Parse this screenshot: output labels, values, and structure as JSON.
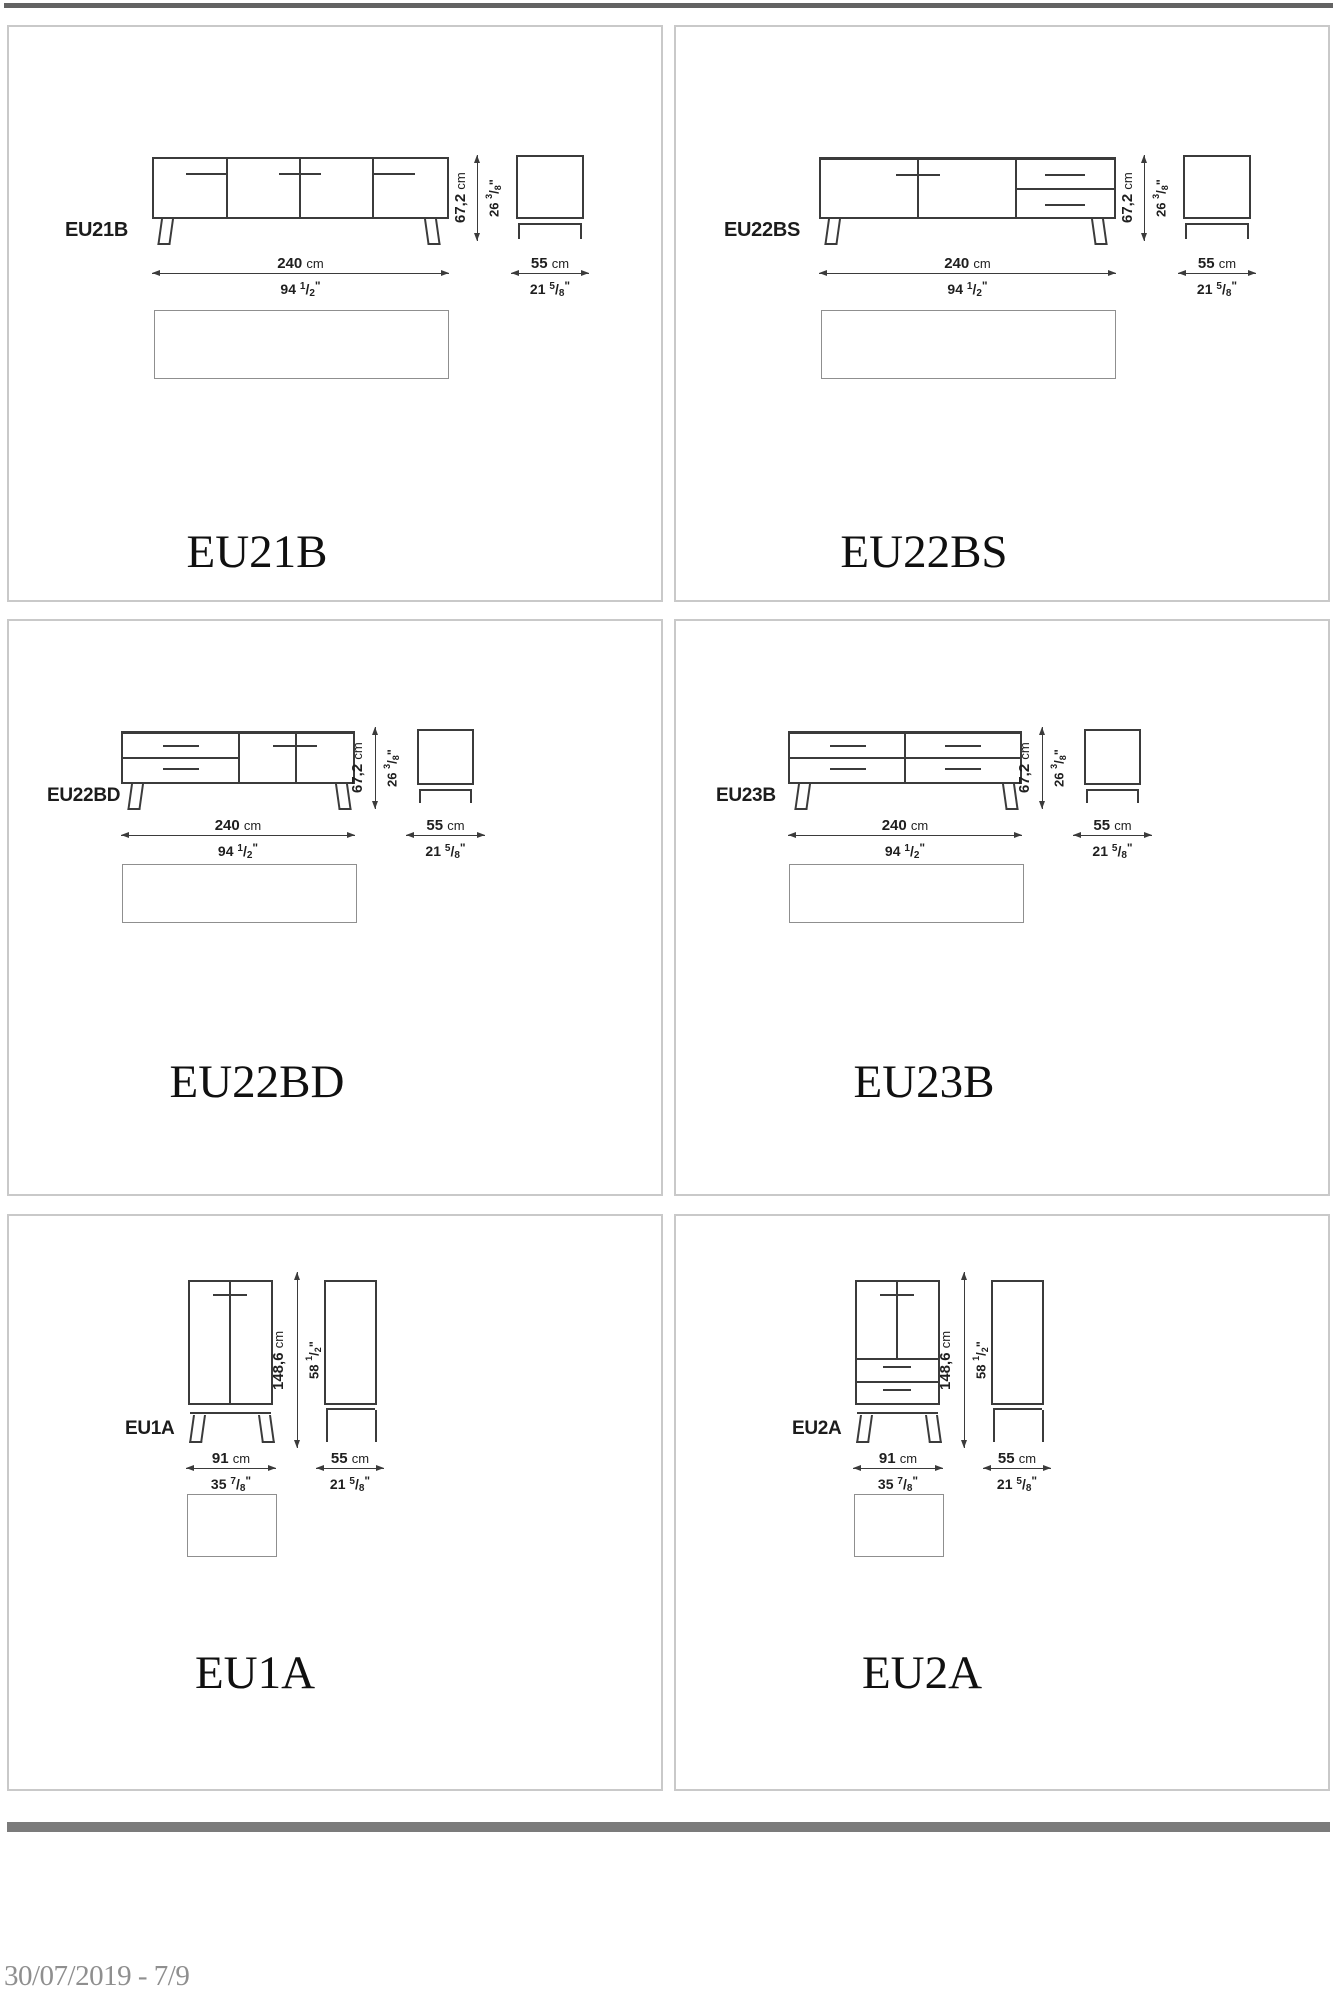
{
  "page": {
    "footer_text": "30/07/2019 - 7/9",
    "top_bar_color": "#636363",
    "footer_bar_color": "#7b7b7b",
    "cell_border_color": "#c9c9c9",
    "drawing_line_color": "#3b3b3b"
  },
  "units": {
    "inch_mark": "\"",
    "frac_slash": "/"
  },
  "cells": [
    {
      "code": "EU21B",
      "name": "EU21B",
      "type": "sideboard-4-doors",
      "wv": "240",
      "wu": "cm",
      "win": "94",
      "wnum": "1",
      "wden": "2",
      "hv": "67,2",
      "hu": "cm",
      "hin": "26",
      "hnum": "3",
      "hden": "8",
      "dv": "55",
      "du": "cm",
      "din": "21",
      "dnum": "5",
      "dden": "8"
    },
    {
      "code": "EU22BS",
      "name": "EU22BS",
      "type": "sideboard-2-doors-2-drawers",
      "wv": "240",
      "wu": "cm",
      "win": "94",
      "wnum": "1",
      "wden": "2",
      "hv": "67,2",
      "hu": "cm",
      "hin": "26",
      "hnum": "3",
      "hden": "8",
      "dv": "55",
      "du": "cm",
      "din": "21",
      "dnum": "5",
      "dden": "8"
    },
    {
      "code": "EU22BD",
      "name": "EU22BD",
      "type": "sideboard-2-drawers-2-doors",
      "wv": "240",
      "wu": "cm",
      "win": "94",
      "wnum": "1",
      "wden": "2",
      "hv": "67,2",
      "hu": "cm",
      "hin": "26",
      "hnum": "3",
      "hden": "8",
      "dv": "55",
      "du": "cm",
      "din": "21",
      "dnum": "5",
      "dden": "8"
    },
    {
      "code": "EU23B",
      "name": "EU23B",
      "type": "sideboard-4-drawers",
      "wv": "240",
      "wu": "cm",
      "win": "94",
      "wnum": "1",
      "wden": "2",
      "hv": "67,2",
      "hu": "cm",
      "hin": "26",
      "hnum": "3",
      "hden": "8",
      "dv": "55",
      "du": "cm",
      "din": "21",
      "dnum": "5",
      "dden": "8"
    },
    {
      "code": "EU1A",
      "name": "EU1A",
      "type": "cabinet-2-doors",
      "wv": "91",
      "wu": "cm",
      "win": "35",
      "wnum": "7",
      "wden": "8",
      "hv": "148,6",
      "hu": "cm",
      "hin": "58",
      "hnum": "1",
      "hden": "2",
      "dv": "55",
      "du": "cm",
      "din": "21",
      "dnum": "5",
      "dden": "8"
    },
    {
      "code": "EU2A",
      "name": "EU2A",
      "type": "cabinet-2-doors-2-drawers",
      "wv": "91",
      "wu": "cm",
      "win": "35",
      "wnum": "7",
      "wden": "8",
      "hv": "148,6",
      "hu": "cm",
      "hin": "58",
      "hnum": "1",
      "hden": "2",
      "dv": "55",
      "du": "cm",
      "din": "21",
      "dnum": "5",
      "dden": "8"
    }
  ]
}
